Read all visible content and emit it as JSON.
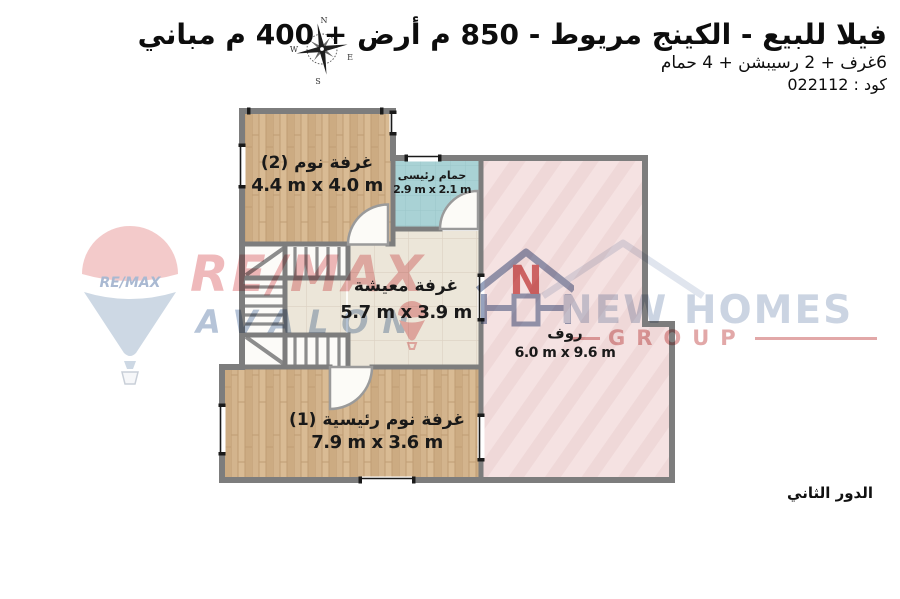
{
  "header": {
    "title": "فيلا للبيع - الكينج مريوط - 850 م أرض + 400 م مباني",
    "subtitle": "6غرف + 2 رسيبشن + 4 حمام",
    "code": "كود : 022112"
  },
  "floor_label": "الدور الثاني",
  "compass": {
    "n": "N",
    "e": "E",
    "s": "S",
    "w": "W"
  },
  "rooms": [
    {
      "id": "bedroom-2",
      "name": "غرفة نوم (2)",
      "dims": "4.4 m x 4.0 m"
    },
    {
      "id": "master-bathroom",
      "name": "حمام رئيسى",
      "dims": "2.9 m x 2.1 m"
    },
    {
      "id": "living-room",
      "name": "غرفة معيشة",
      "dims": "5.7 m x 3.9 m"
    },
    {
      "id": "roof",
      "name": "روف",
      "dims": "6.0 m x 9.6 m"
    },
    {
      "id": "master-bedroom-1",
      "name": "غرفة نوم رئيسية (1)",
      "dims": "7.9 m x 3.6 m"
    }
  ],
  "watermarks": {
    "remax": {
      "balloon_label": "RE/MAX",
      "brand": "RE/MAX",
      "name": "AVALON"
    },
    "newhomes": {
      "letter": "N",
      "brand": "NEW HOMES",
      "group": "GROUP"
    }
  },
  "colors": {
    "wall": "#7d7d7d",
    "wood_floor": "#d3b48d",
    "bathroom_floor": "#a9d2d5",
    "tile_floor": "#ece6d9",
    "roof_floor": "#f5e2e2",
    "remax_red": "#efb9bb",
    "remax_blue": "#b6c4d8",
    "newhomes_navy": "#cbd4e2",
    "newhomes_red": "#e2a8a8"
  }
}
